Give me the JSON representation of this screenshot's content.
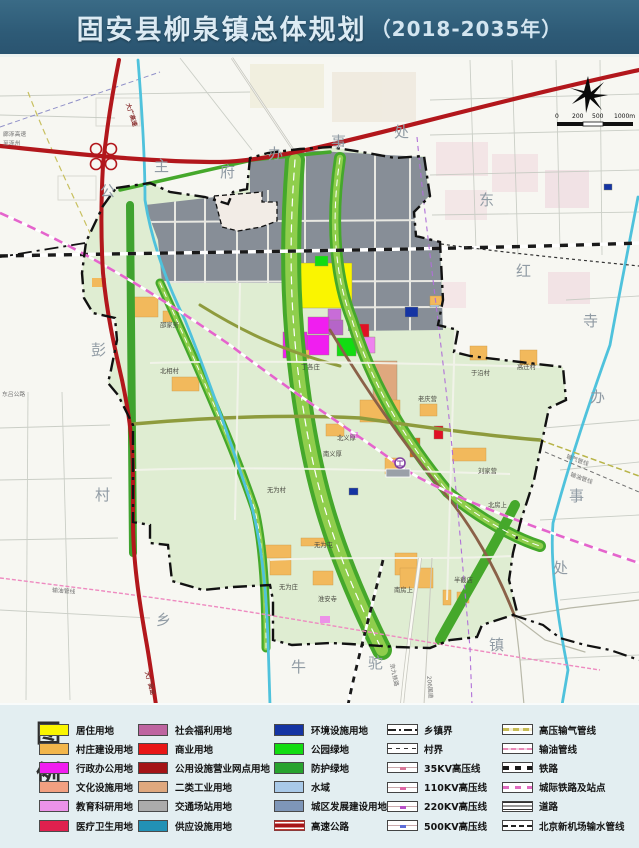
{
  "title": {
    "main": "固安县柳泉镇总体规划",
    "period": "（2018-2035年）"
  },
  "map": {
    "scale": {
      "t0": "0",
      "t1": "200",
      "t2": "500",
      "t3": "1000m"
    },
    "compass": "north-compass-rose",
    "peripheral": [
      {
        "t": "公"
      },
      {
        "t": "主"
      },
      {
        "t": "府"
      },
      {
        "t": "办"
      },
      {
        "t": "事"
      },
      {
        "t": "处"
      },
      {
        "t": "东"
      },
      {
        "t": "红"
      },
      {
        "t": "寺"
      },
      {
        "t": "办"
      },
      {
        "t": "事"
      },
      {
        "t": "处"
      },
      {
        "t": "彭"
      },
      {
        "t": "村"
      },
      {
        "t": "乡"
      },
      {
        "t": "牛"
      },
      {
        "t": "驼"
      },
      {
        "t": "镇"
      }
    ],
    "villages": [
      {
        "name": "邵家务"
      },
      {
        "name": "北相村"
      },
      {
        "name": "丁各庄"
      },
      {
        "name": "于沿村"
      },
      {
        "name": "高迁村"
      },
      {
        "name": "老庆营"
      },
      {
        "name": "北义厚"
      },
      {
        "name": "南义厚"
      },
      {
        "name": "刘家营"
      },
      {
        "name": "北房上"
      },
      {
        "name": "无为村"
      },
      {
        "name": "无为屯"
      },
      {
        "name": "无为庄"
      },
      {
        "name": "淮安寺"
      },
      {
        "name": "半截店"
      },
      {
        "name": "南房上"
      }
    ],
    "roads": [
      {
        "text": "大广高速"
      },
      {
        "text": "廊涿高速"
      },
      {
        "text": "至涿州"
      },
      {
        "text": "大广高速"
      },
      {
        "text": "206国道"
      },
      {
        "text": "京九铁路"
      },
      {
        "text": "东吕公路"
      },
      {
        "text": "输油管线"
      },
      {
        "text": "输气管线"
      }
    ]
  },
  "legend": {
    "heading": [
      {
        "t": "图"
      },
      {
        "t": "例"
      }
    ],
    "cols": [
      {
        "items": [
          {
            "label": "居住用地",
            "color": "#FAF500"
          },
          {
            "label": "村庄建设用地",
            "color": "#F2B64B"
          },
          {
            "label": "行政办公用地",
            "color": "#F01EF0"
          },
          {
            "label": "文化设施用地",
            "color": "#F2A081"
          },
          {
            "label": "教育科研用地",
            "color": "#EC92E8"
          },
          {
            "label": "医疗卫生用地",
            "color": "#E0204E"
          }
        ]
      },
      {
        "items": [
          {
            "label": "社会福利用地",
            "color": "#BE64A0"
          },
          {
            "label": "商业用地",
            "color": "#E81616"
          },
          {
            "label": "公用设施营业网点用地",
            "color": "#A41316"
          },
          {
            "label": "二类工业用地",
            "color": "#DFA87E"
          },
          {
            "label": "交通场站用地",
            "color": "#ABABAB"
          },
          {
            "label": "供应设施用地",
            "color": "#2291B5"
          }
        ]
      },
      {
        "items": [
          {
            "label": "环境设施用地",
            "color": "#1534A3"
          },
          {
            "label": "公园绿地",
            "color": "#12DC12"
          },
          {
            "label": "防护绿地",
            "color": "#28A32E"
          },
          {
            "label": "水域",
            "color": "#A9C9E8"
          },
          {
            "label": "城区发展建设用地",
            "color": "#7E96B8"
          },
          {
            "label": "高速公路",
            "color": "#A81418"
          }
        ]
      },
      {
        "items": [
          {
            "label": "乡镇界"
          },
          {
            "label": "村界"
          },
          {
            "label": "35KV高压线"
          },
          {
            "label": "110KV高压线"
          },
          {
            "label": "220KV高压线"
          },
          {
            "label": "500KV高压线"
          }
        ]
      },
      {
        "items": [
          {
            "label": "高压输气管线"
          },
          {
            "label": "输油管线"
          },
          {
            "label": "铁路"
          },
          {
            "label": "城际铁路及站点"
          },
          {
            "label": "道路"
          },
          {
            "label": "北京新机场输水管线"
          }
        ]
      }
    ]
  }
}
